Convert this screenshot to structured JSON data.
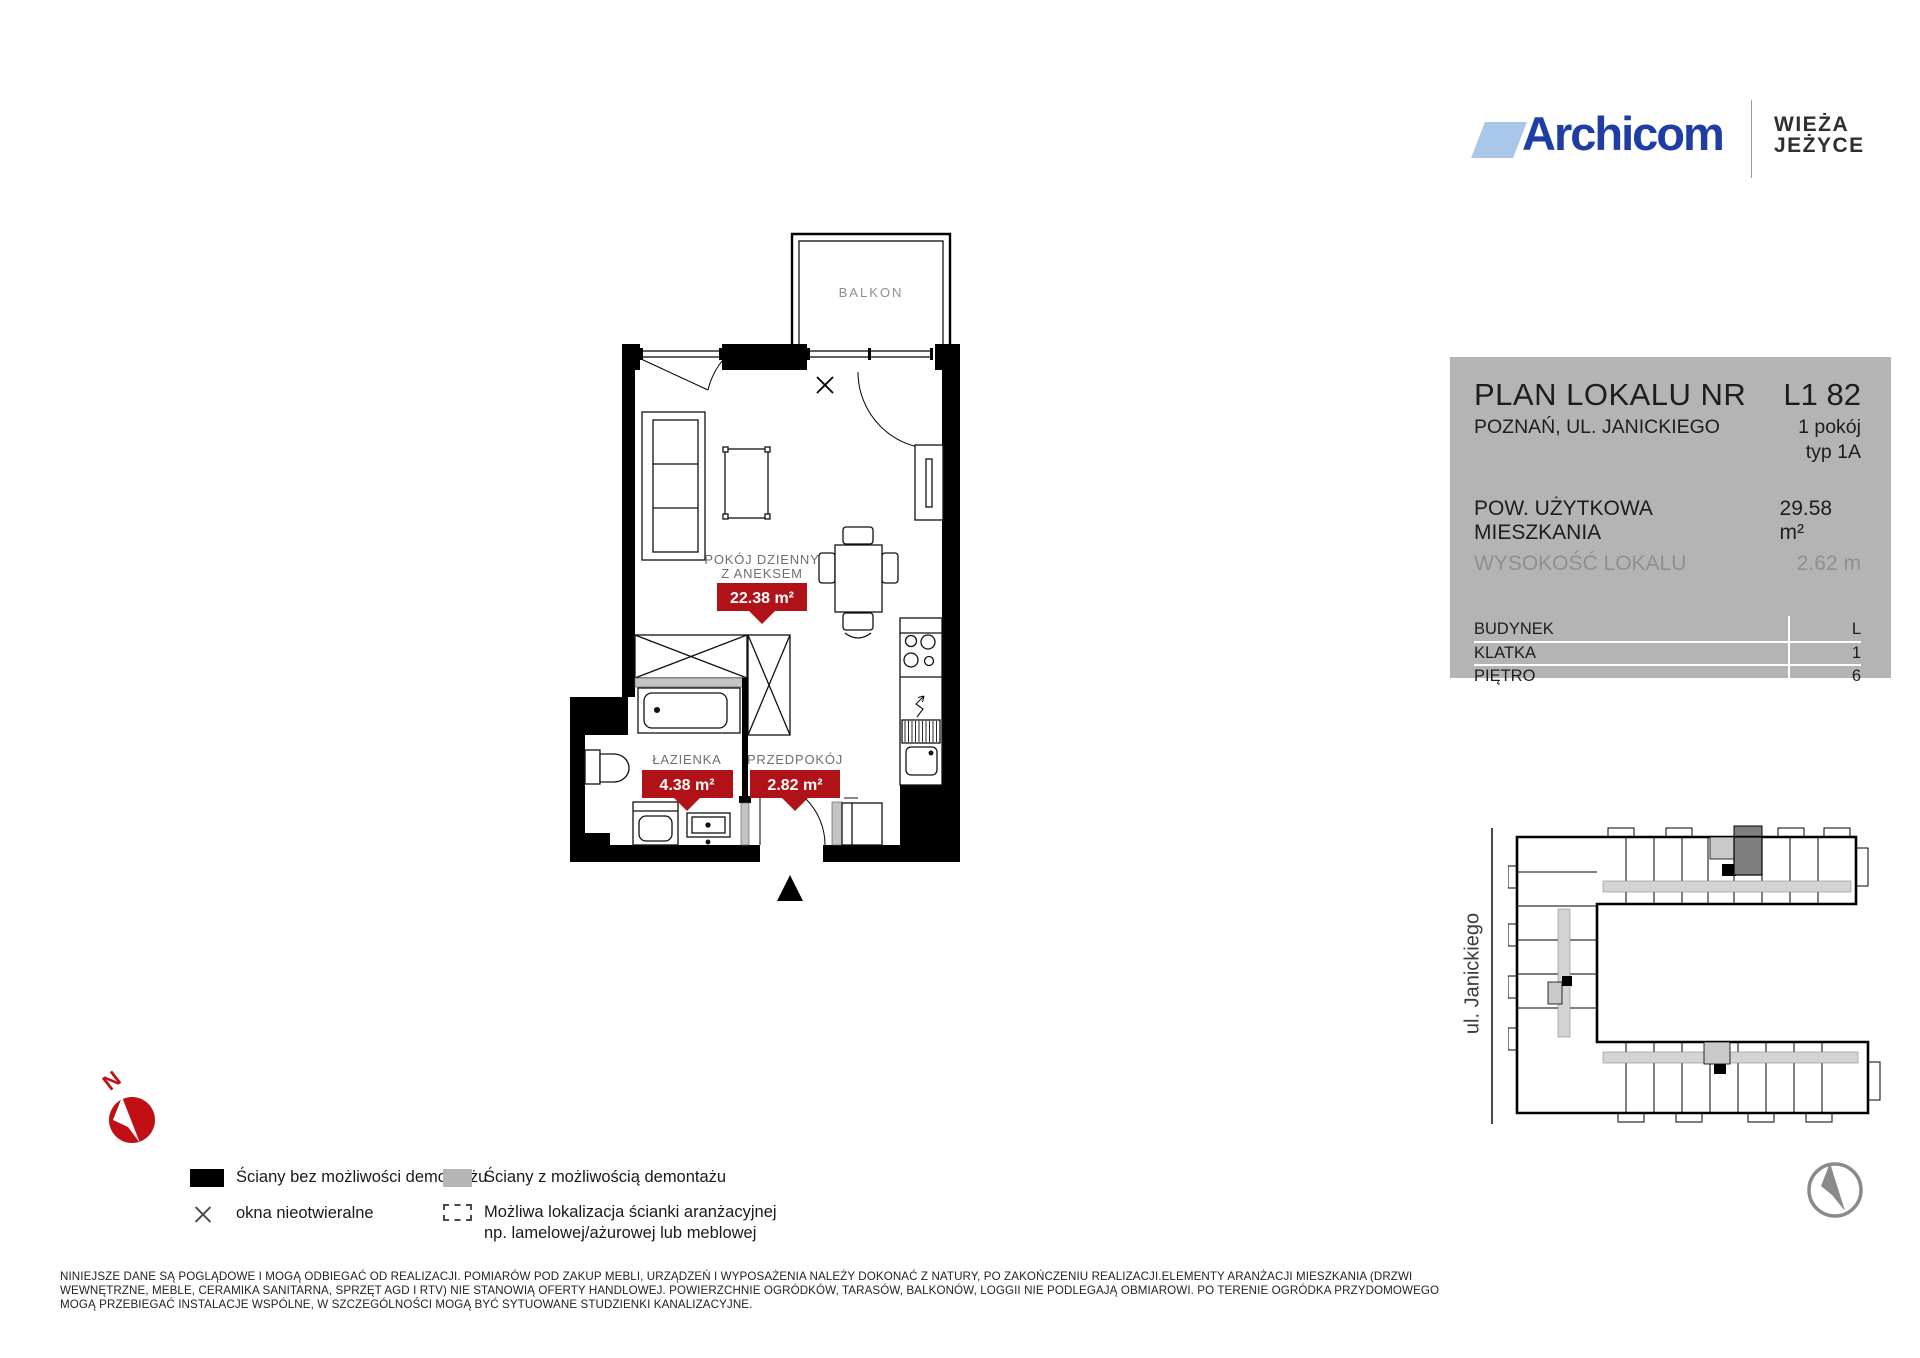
{
  "brand": {
    "name": "Archicom",
    "project": [
      "WIEŻA",
      "JEŻYCE"
    ]
  },
  "panel": {
    "title": "PLAN LOKALU NR",
    "unit_number": "L1 82",
    "address": "POZNAŃ, UL. JANICKIEGO",
    "rooms_count": "1 pokój",
    "unit_type": "typ 1A",
    "area_label": "POW. UŻYTKOWA MIESZKANIA",
    "area_value": "29.58 m²",
    "height_label": "WYSOKOŚĆ LOKALU",
    "height_value": "2.62 m",
    "table": [
      {
        "label": "BUDYNEK",
        "value": "L"
      },
      {
        "label": "KLATKA",
        "value": "1"
      },
      {
        "label": "PIĘTRO",
        "value": "6"
      }
    ]
  },
  "plan": {
    "balcony_label": "BALKON",
    "living_room": {
      "name_line1": "POKÓJ DZIENNY",
      "name_line2": "Z ANEKSEM",
      "area": "22.38 m²"
    },
    "bathroom": {
      "name": "ŁAZIENKA",
      "area": "4.38 m²"
    },
    "hall": {
      "name": "PRZEDPOKÓJ",
      "area": "2.82 m²"
    },
    "badge_color": "#b11218"
  },
  "map": {
    "street_label": "ul. Janickiego"
  },
  "compass": {
    "north_label": "N"
  },
  "legend": [
    {
      "label": "Ściany bez możliwości demontażu"
    },
    {
      "label": "okna nieotwieralne"
    },
    {
      "label": "Ściany z możliwością demontażu"
    },
    {
      "label": "Możliwa lokalizacja ścianki aranżacyjnej",
      "label2": "np. lamelowej/ażurowej lub meblowej"
    }
  ],
  "disclaimer": [
    "NINIEJSZE DANE SĄ POGLĄDOWE I MOGĄ ODBIEGAĆ OD REALIZACJI. POMIARÓW POD ZAKUP MEBLI, URZĄDZEŃ I WYPOSAŻENIA NALEŻY DOKONAĆ Z NATURY, PO ZAKOŃCZENIU REALIZACJI.ELEMENTY ARANŻACJI MIESZKANIA (DRZWI",
    "WEWNĘTRZNE, MEBLE, CERAMIKA SANITARNA, SPRZĘT AGD I RTV) NIE STANOWIĄ OFERTY HANDLOWEJ. POWIERZCHNIE OGRÓDKÓW, TARASÓW, BALKONÓW, LOGGII NIE PODLEGAJĄ OBMIAROWI. PO TERENIE OGRÓDKA PRZYDOMOWEGO",
    "MOGĄ PRZEBIEGAĆ INSTALACJE WSPÓLNE,  W SZCZEGÓLNOŚCI MOGĄ BYĆ SYTUOWANE STUDZIENKI KANALIZACYJNE."
  ]
}
